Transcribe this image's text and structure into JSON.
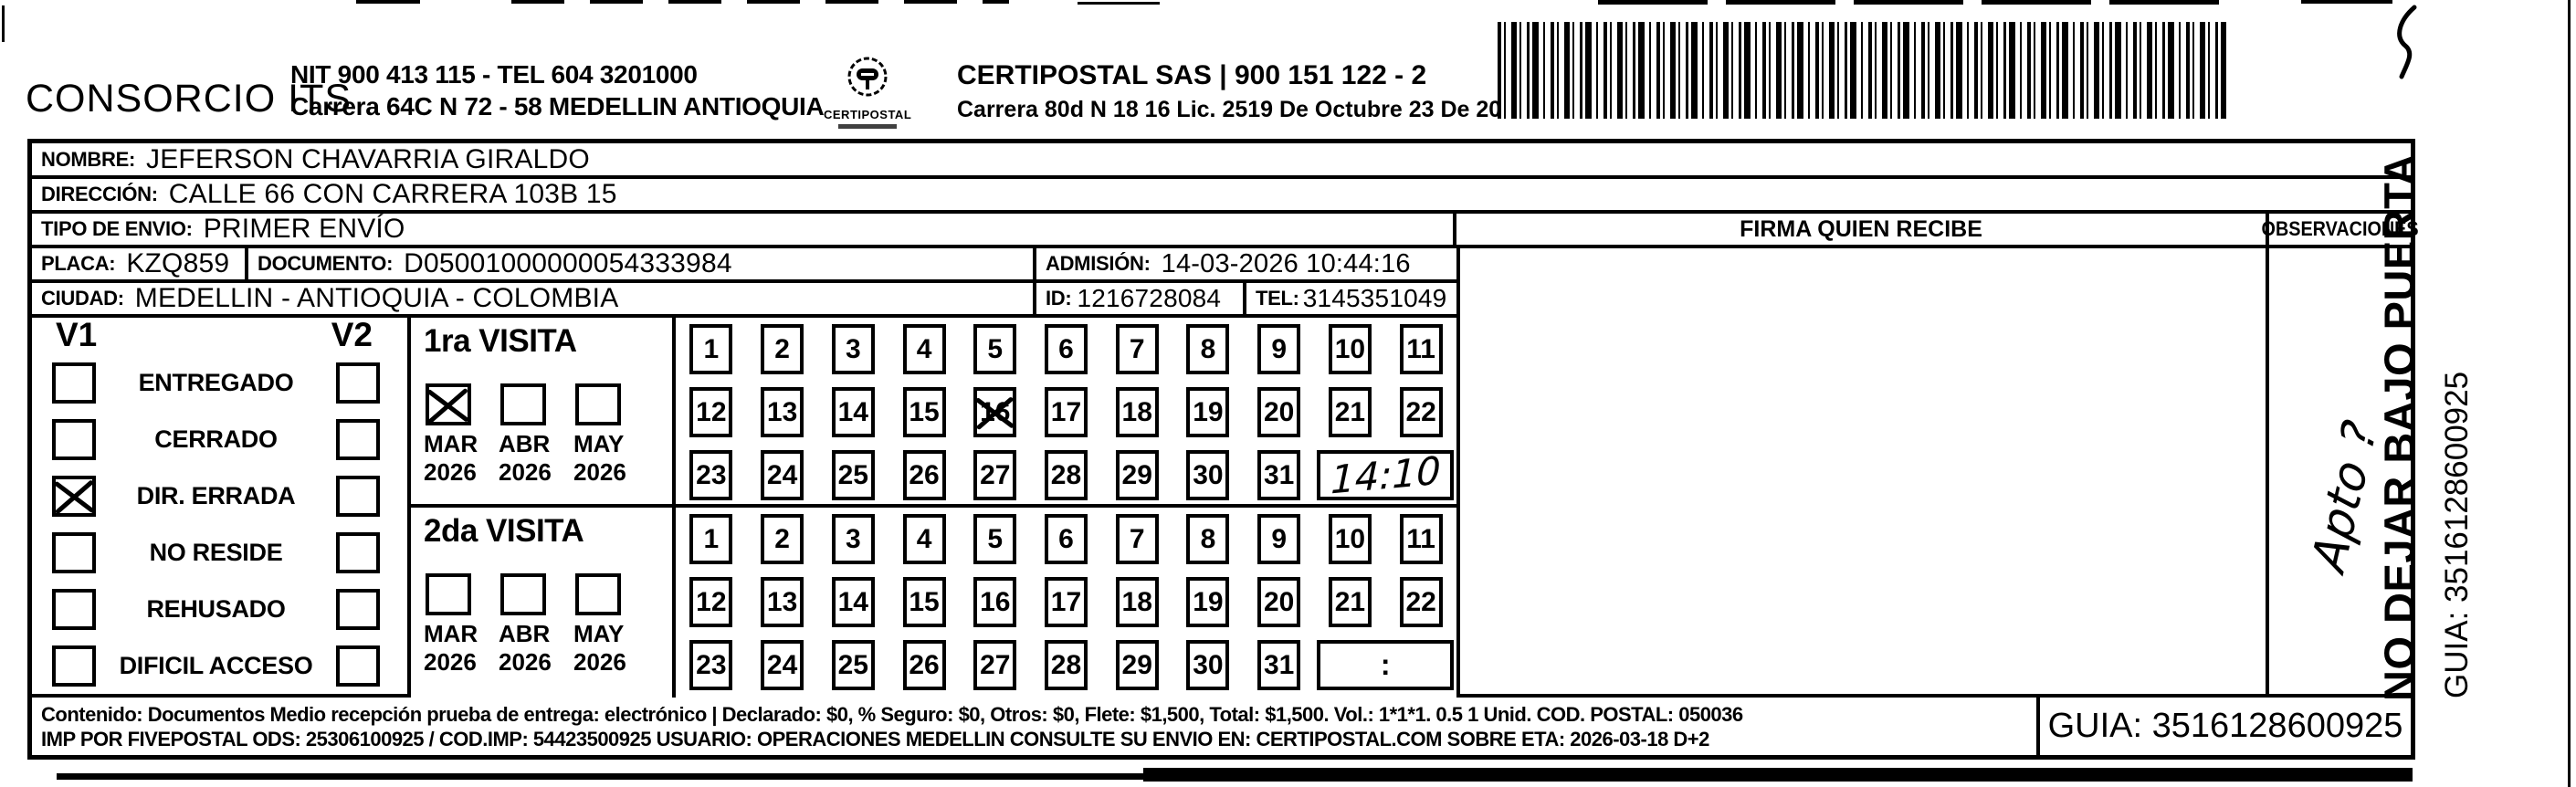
{
  "colors": {
    "ink": "#000000",
    "paper": "#ffffff"
  },
  "header": {
    "company": "CONSORCIO ITS",
    "nit_line1": "NIT 900 413 115 - TEL 604 3201000",
    "nit_line2": "Carrera 64C N 72 - 58 MEDELLIN ANTIOQUIA",
    "logo_text": "CERTIPOSTAL",
    "certipostal_line1": "CERTIPOSTAL SAS | 900 151 122 - 2",
    "certipostal_line2": "Carrera 80d N 18 16  Lic. 2519 De Octubre 23 De 2015"
  },
  "fields": {
    "nombre": {
      "label": "NOMBRE:",
      "value": "JEFERSON CHAVARRIA GIRALDO"
    },
    "direccion": {
      "label": "DIRECCIÓN:",
      "value": "CALLE 66 CON CARRERA 103B 15"
    },
    "tipo_envio": {
      "label": "TIPO DE ENVIO:",
      "value": "PRIMER ENVÍO"
    },
    "placa": {
      "label": "PLACA:",
      "value": "KZQ859"
    },
    "documento": {
      "label": "DOCUMENTO:",
      "value": "D05001000000054333984"
    },
    "admision": {
      "label": "ADMISIÓN:",
      "value": "14-03-2026 10:44:16"
    },
    "ciudad": {
      "label": "CIUDAD:",
      "value": "MEDELLIN - ANTIOQUIA - COLOMBIA"
    },
    "id": {
      "label": "ID:",
      "value": "1216728084"
    },
    "tel": {
      "label": "TEL:",
      "value": "3145351049"
    }
  },
  "columns": {
    "firma": "FIRMA QUIEN RECIBE",
    "observaciones": "OBSERVACIONES"
  },
  "status": {
    "col1": "V1",
    "col2": "V2",
    "items": [
      {
        "label": "ENTREGADO",
        "v1": false,
        "v2": false
      },
      {
        "label": "CERRADO",
        "v1": false,
        "v2": false
      },
      {
        "label": "DIR. ERRADA",
        "v1": true,
        "v2": false
      },
      {
        "label": "NO RESIDE",
        "v1": false,
        "v2": false
      },
      {
        "label": "REHUSADO",
        "v1": false,
        "v2": false
      },
      {
        "label": "DIFICIL ACCESO",
        "v1": false,
        "v2": false
      }
    ]
  },
  "day_rows": [
    [
      "1",
      "2",
      "3",
      "4",
      "5",
      "6",
      "7",
      "8",
      "9",
      "10",
      "11"
    ],
    [
      "12",
      "13",
      "14",
      "15",
      "16",
      "17",
      "18",
      "19",
      "20",
      "21",
      "22"
    ],
    [
      "23",
      "24",
      "25",
      "26",
      "27",
      "28",
      "29",
      "30",
      "31"
    ]
  ],
  "visits": [
    {
      "title": "1ra VISITA",
      "months": [
        {
          "month": "MAR",
          "year": "2026",
          "checked": true
        },
        {
          "month": "ABR",
          "year": "2026",
          "checked": false
        },
        {
          "month": "MAY",
          "year": "2026",
          "checked": false
        }
      ],
      "marked_day": "16",
      "time": "14:10",
      "time_handwritten": true
    },
    {
      "title": "2da VISITA",
      "months": [
        {
          "month": "MAR",
          "year": "2026",
          "checked": false
        },
        {
          "month": "ABR",
          "year": "2026",
          "checked": false
        },
        {
          "month": "MAY",
          "year": "2026",
          "checked": false
        }
      ],
      "marked_day": "",
      "time": ":",
      "time_handwritten": false
    }
  ],
  "handwriting": {
    "observation_note": "Apto ?",
    "first_visit_time": "14:10"
  },
  "side": {
    "warning": "NO DEJAR BAJO PUERTA",
    "guia": "GUIA: 3516128600925"
  },
  "footer": {
    "line1": "Contenido: Documentos Medio recepción prueba de entrega: electrónico | Declarado: $0, % Seguro: $0, Otros: $0, Flete: $1,500, Total: $1,500. Vol.: 1*1*1. 0.5 1 Unid. COD. POSTAL: 050036",
    "line2": "IMP POR FIVEPOSTAL ODS: 25306100925 / COD.IMP: 54423500925 USUARIO: OPERACIONES MEDELLIN CONSULTE SU ENVIO EN: CERTIPOSTAL.COM SOBRE ETA: 2026-03-18 D+2",
    "guia_box": "GUIA: 3516128600925"
  }
}
